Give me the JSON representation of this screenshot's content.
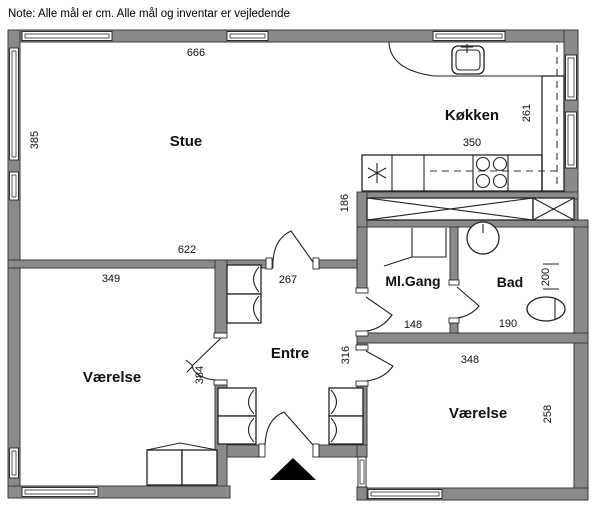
{
  "note": "Note: Alle mål er cm. Alle mål og inventar er vejledende",
  "rooms": {
    "stue": "Stue",
    "kokken": "Køkken",
    "mlgang": "Ml.Gang",
    "bad": "Bad",
    "entre": "Entre",
    "vaerelse_left": "Værelse",
    "vaerelse_right": "Værelse"
  },
  "dims": {
    "d666": "666",
    "d385": "385",
    "d622": "622",
    "d349": "349",
    "d267": "267",
    "d384": "384",
    "d186": "186",
    "d350": "350",
    "d261": "261",
    "d148": "148",
    "d316": "316",
    "d190": "190",
    "d200": "200",
    "d348": "348",
    "d258": "258"
  },
  "colors": {
    "wall": "#8a8a8a",
    "outline": "#3a3a3a",
    "fixture_line": "#222222",
    "background": "#ffffff"
  }
}
